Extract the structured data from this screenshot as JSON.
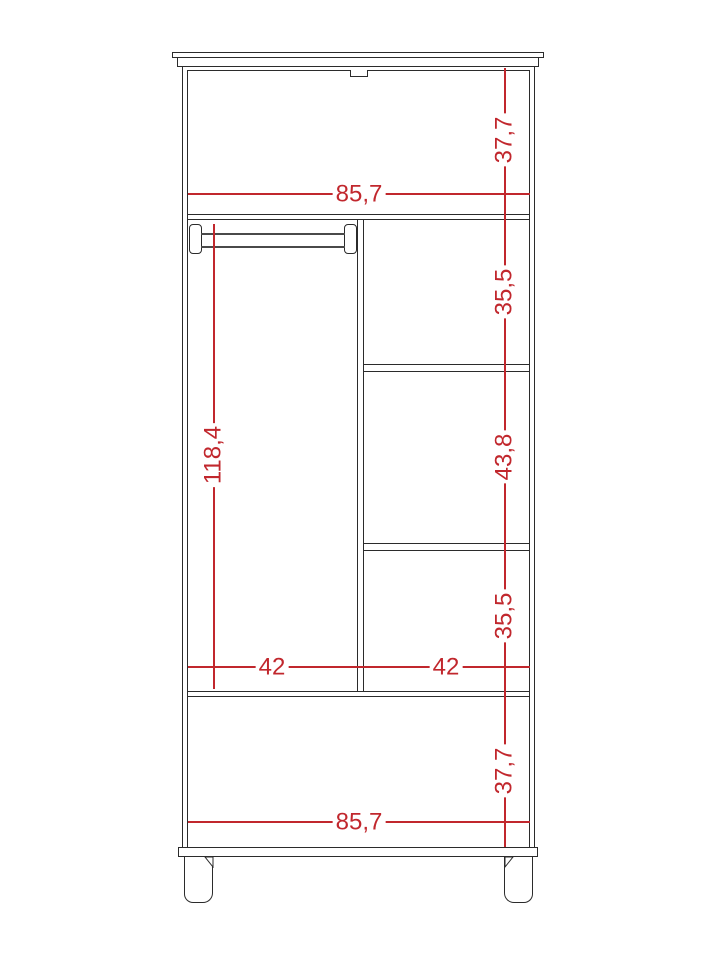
{
  "meta": {
    "title": "Wardrobe front-elevation dimension drawing",
    "drawing_type": "furniture technical diagram",
    "number_format": "decimal comma"
  },
  "colors": {
    "outline": "#2b2b2b",
    "dimension_red": "#c1272d",
    "background": "#ffffff"
  },
  "dimensions": {
    "top_panel_height": "37,7",
    "top_interior_width": "85,7",
    "right_top_compartment_height": "35,5",
    "right_middle_compartment_height": "43,8",
    "right_bottom_compartment_height": "35,5",
    "left_compartment_height": "118,4",
    "left_compartment_width": "42",
    "right_compartment_width": "42",
    "bottom_panel_height": "37,7",
    "bottom_interior_width": "85,7"
  }
}
